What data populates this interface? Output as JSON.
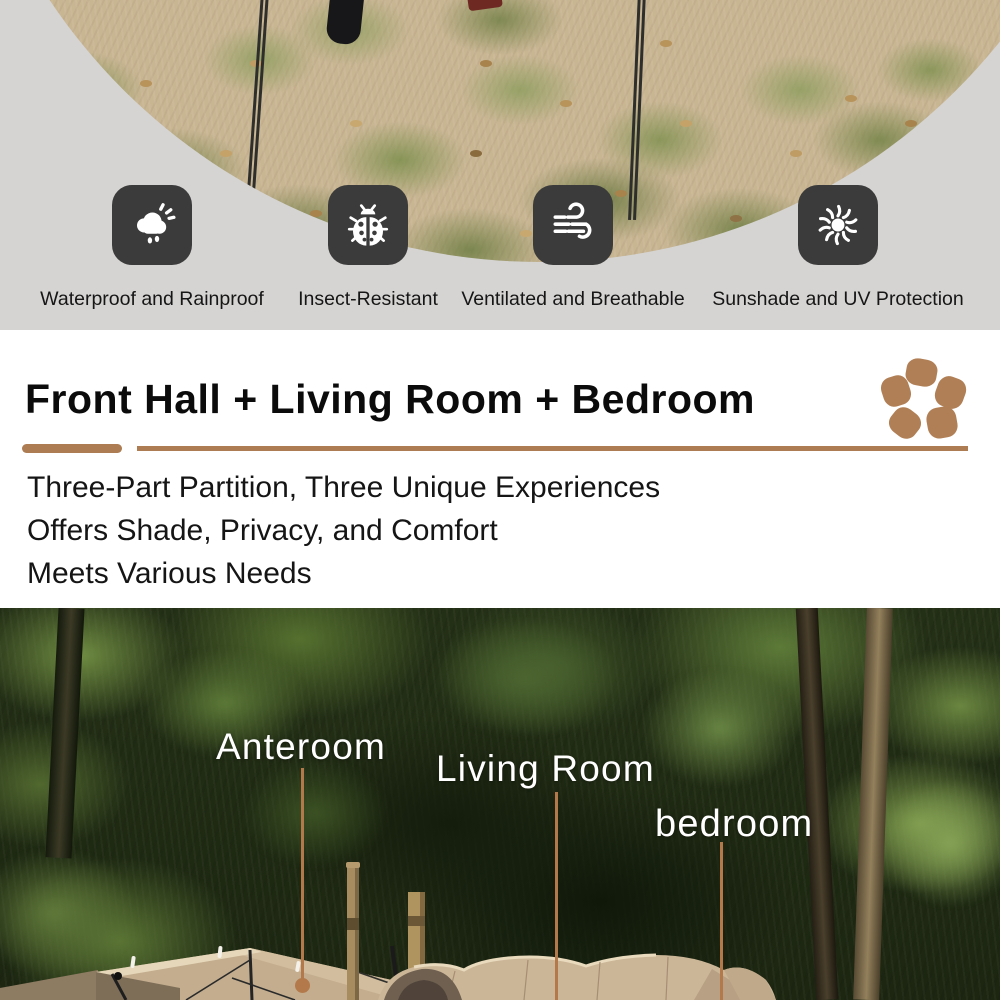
{
  "features": [
    {
      "icon": "rain-cloud-icon",
      "label": "Waterproof and Rainproof"
    },
    {
      "icon": "ladybug-icon",
      "label": "Insect-Resistant"
    },
    {
      "icon": "wind-icon",
      "label": "Ventilated and Breathable"
    },
    {
      "icon": "sun-icon",
      "label": "Sunshade and UV Protection"
    }
  ],
  "headline": {
    "title": "Front Hall + Living Room + Bedroom",
    "description_lines": [
      "Three-Part Partition, Three Unique Experiences",
      "Offers Shade, Privacy, and Comfort",
      "Meets Various Needs"
    ]
  },
  "photo_labels": {
    "anteroom": "Anteroom",
    "living_room": "Living Room",
    "bedroom": "bedroom"
  },
  "colors": {
    "accent_brown": "#ad7c52",
    "pebble_brown": "#b17f55",
    "icon_background": "#3b3b3b",
    "leader_line": "#b3794a",
    "top_background": "#d5d4d2",
    "mid_background": "#ffffff"
  }
}
